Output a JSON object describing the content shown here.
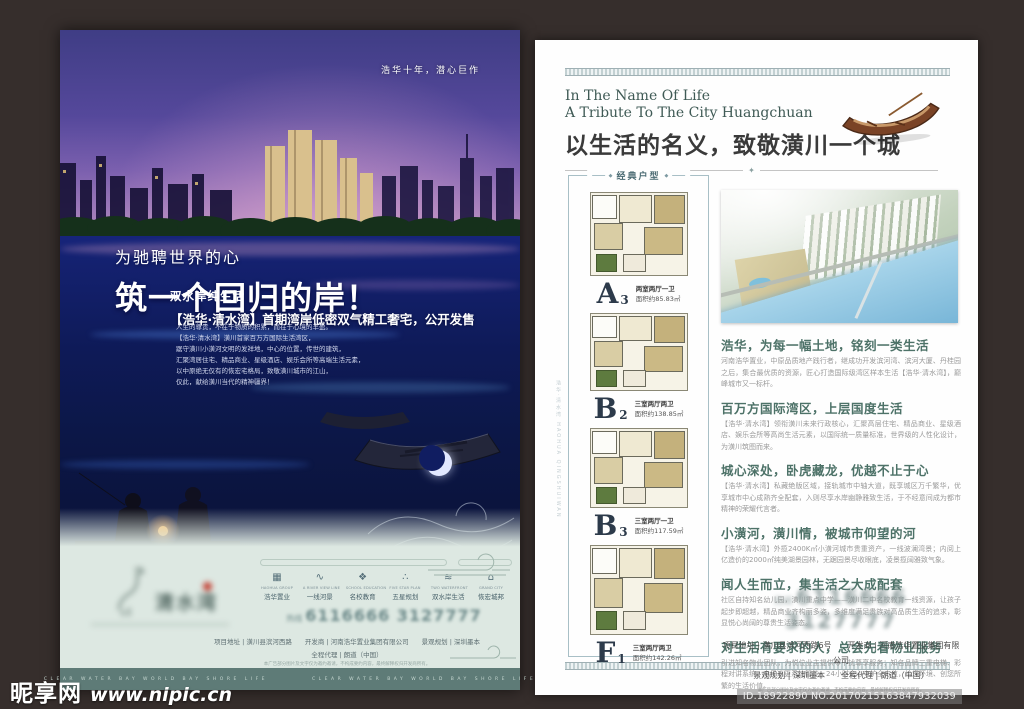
{
  "colors": {
    "accent_teal": "#4d7268",
    "poster_sky": "#55489b",
    "poster_water": "#1b2b8f",
    "footer_bg": "#dde8e2",
    "band_bg": "#5e7b77",
    "plan_letter": "#2c3a4a"
  },
  "watermark": {
    "site_name": "昵享网",
    "site_url": "www.nipic.cn",
    "id_text": "ID.18922890 NO.20170215163847932039"
  },
  "poster": {
    "tagline": "浩华十年，潜心巨作",
    "subtitle": "为驰聘世界的心",
    "title": "筑一个回归的岸！",
    "slogan": "双水岸纯生活",
    "announce": "【浩华·清水湾】首期湾岸低密双气精工奢宅，公开发售",
    "body_lines": [
      "人生的尊贵，不在于物质的积累，而在于心境的丰盈。",
      "【浩华·清水湾】潢川首家百万方国际生活湾区，",
      "踞守潢川小潢河文明的发祥地，中心的位置，传世的建筑，",
      "汇聚湾居住宅、精品商业、星级酒店、娱乐会所等高端生活元素，",
      "以中原绝无仅有的恢宏宅格局，致敬潢川城市的江山，",
      "仅此，献给潢川当代的精神疆界！"
    ],
    "footer": {
      "logo_text": "清水湾",
      "icons": [
        {
          "en": "HAOHUA GROUP",
          "cn": "浩华置业",
          "glyph": "▦"
        },
        {
          "en": "A RIVER VIEW LINE",
          "cn": "一线河景",
          "glyph": "∿"
        },
        {
          "en": "SCHOOL EDUCATION",
          "cn": "名校教育",
          "glyph": "❖"
        },
        {
          "en": "FIVE STAR PLAN",
          "cn": "五星规划",
          "glyph": "∴"
        },
        {
          "en": "TWO WATERFRONT",
          "cn": "双水岸生活",
          "glyph": "≋"
        },
        {
          "en": "GRAND CITY",
          "cn": "恢宏城邦",
          "glyph": "⌂"
        }
      ],
      "hotline_prefix": "热线",
      "phone": "6116666  3127777",
      "info_line1": "项目地址 | 潢川县滨河西路　　开发商 | 河南浩华置业集团有限公司　　景观规划 | 深圳墨本",
      "info_line2": "全程代理 | 朗道（中国）",
      "disclaimer": "本广告部分图片及文字仅为邀约邀请，不构成要约内容，最终解释权归开发商所有。",
      "band_text": "CLEAR WATER BAY WORLD BAY SHORE LIFE"
    }
  },
  "page": {
    "header": {
      "en_line1": "In The Name Of Life",
      "en_line2": "A Tribute To The City Huangchuan",
      "cn_title": "以生活的名义，致敬潢川一个城"
    },
    "side_text": "浩华·清水湾 HAOHUA QINGSHUIWAN",
    "floorplans": {
      "panel_title": "经典户型",
      "items": [
        {
          "letter": "A",
          "sub": "3",
          "type": "两室两厅一卫",
          "area": "面积约85.83㎡"
        },
        {
          "letter": "B",
          "sub": "2",
          "type": "三室两厅两卫",
          "area": "面积约138.85㎡"
        },
        {
          "letter": "B",
          "sub": "3",
          "type": "三室两厅一卫",
          "area": "面积约117.59㎡"
        },
        {
          "letter": "F",
          "sub": "1",
          "type": "三室两厅两卫",
          "area": "面积约142.26㎡"
        }
      ]
    },
    "sections": [
      {
        "heading": "浩华，为每一幅土地，铭刻一类生活",
        "body": "河南浩华置业，中原品质地产践行者，继成功开发滨河湾、滨河大厦、丹桂园之后，集合最优质的资源，匠心打造国际级湾区样本生活【浩华·清水湾】，巅峰城市又一标杆。"
      },
      {
        "heading": "百万方国际湾区，上层国度生活",
        "body": "【浩华·清水湾】领衔潢川未来行政核心，汇聚高层住宅、精品商业、星级酒店、娱乐会所等高尚生活元素，以国际统一质量标准，世界级的人性化设计，为潢川筑图而来。"
      },
      {
        "heading": "城心深处，卧虎藏龙，优越不止于心",
        "body": "【浩华·清水湾】私藏绝版区域，接轨城市中轴大道，既享城区万千繁华，优享城市中心成熟齐全配套，入则尽享水岸幽静雅致生活，于不经意间成为都市精神的荣耀代言者。"
      },
      {
        "heading": "小潢河，潢川情，被城市仰望的河",
        "body": "【浩华·清水湾】外揽2400K㎡小潢河城市贵重资产，一线波澜湾景；内阅上亿造价的2000㎡纯美湖景园林，无踞园景尽收眼底，凌景揽阔雅致气象。"
      },
      {
        "heading": "闻人生而立，集生活之大成配套",
        "body": "社区自持知名幼儿园，潢川重点中学——潢川二中名校教育一线资源，让孩子起步即超越，精品商业齐构丽多姿，多维度满足贵族对高品质生活的追求，彰显悦心尚阔的尊贵生活姿态。"
      },
      {
        "heading": "对生活有要求的人，总会先看物业服务",
        "body": "引进知名物业团队，为悦位业主提供零干扰尊享服务；知名品牌三重电梯、彩程对讲系统、电子巡更系统智能，24小时全心守护全方位，给您环境、创您所繁的生活价值。"
      }
    ],
    "contact": {
      "hotline_prefix": "热线",
      "phone": "6116666  3127777",
      "line1": "项目地址 | 潢川县滨河西路6号　　开发商 | 河南浩华置业集团有限公司",
      "line2": "景观规划 | 深圳墨本　　全程代理 | 朗道（中国）",
      "disclaimer": "本广告部分图片及文字仅为邀约邀请，不构成要约内容，最终解释权归开发商所有。"
    }
  }
}
